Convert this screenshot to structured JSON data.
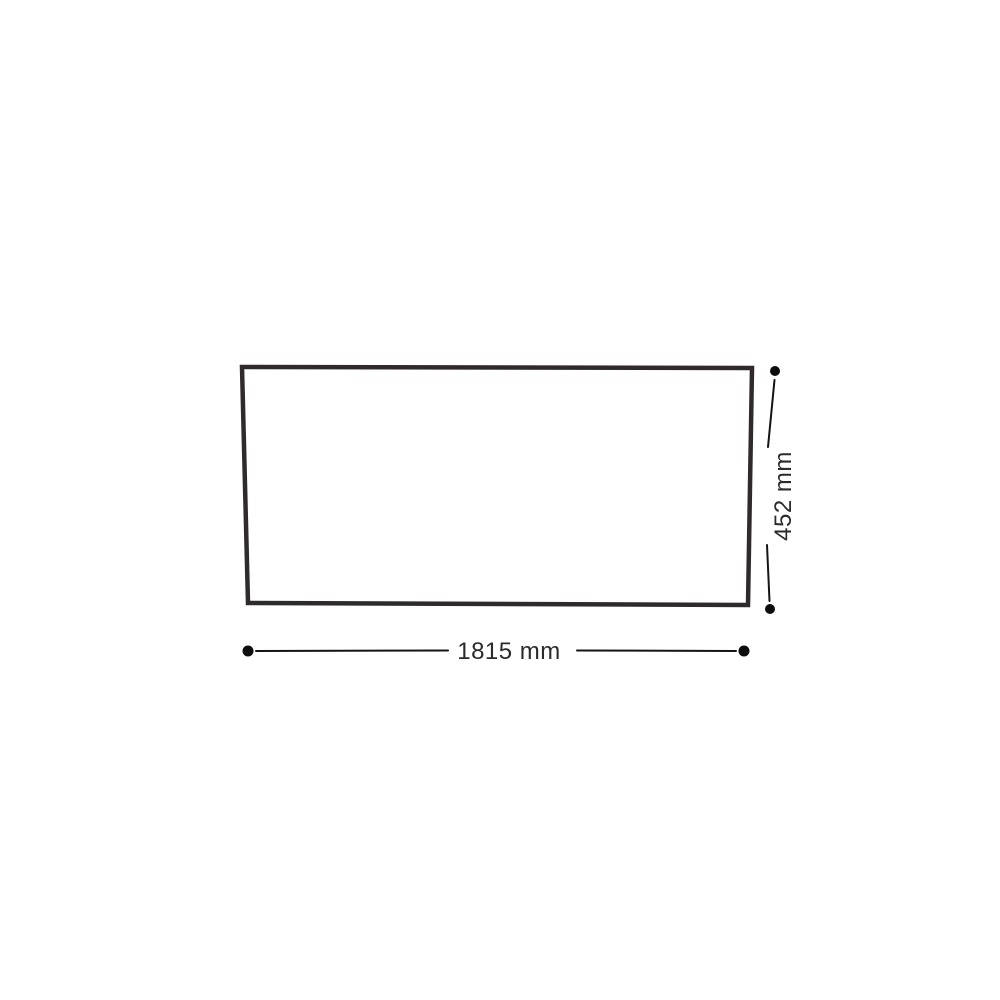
{
  "diagram": {
    "width_label": "1815 mm",
    "height_label": "452 mm",
    "colors": {
      "background": "#ffffff",
      "frame_stroke": "#2f2b2c",
      "dimension_line": "#141414",
      "endpoint_dot": "#0d0d0d",
      "label_text": "#2b2b2b"
    }
  }
}
